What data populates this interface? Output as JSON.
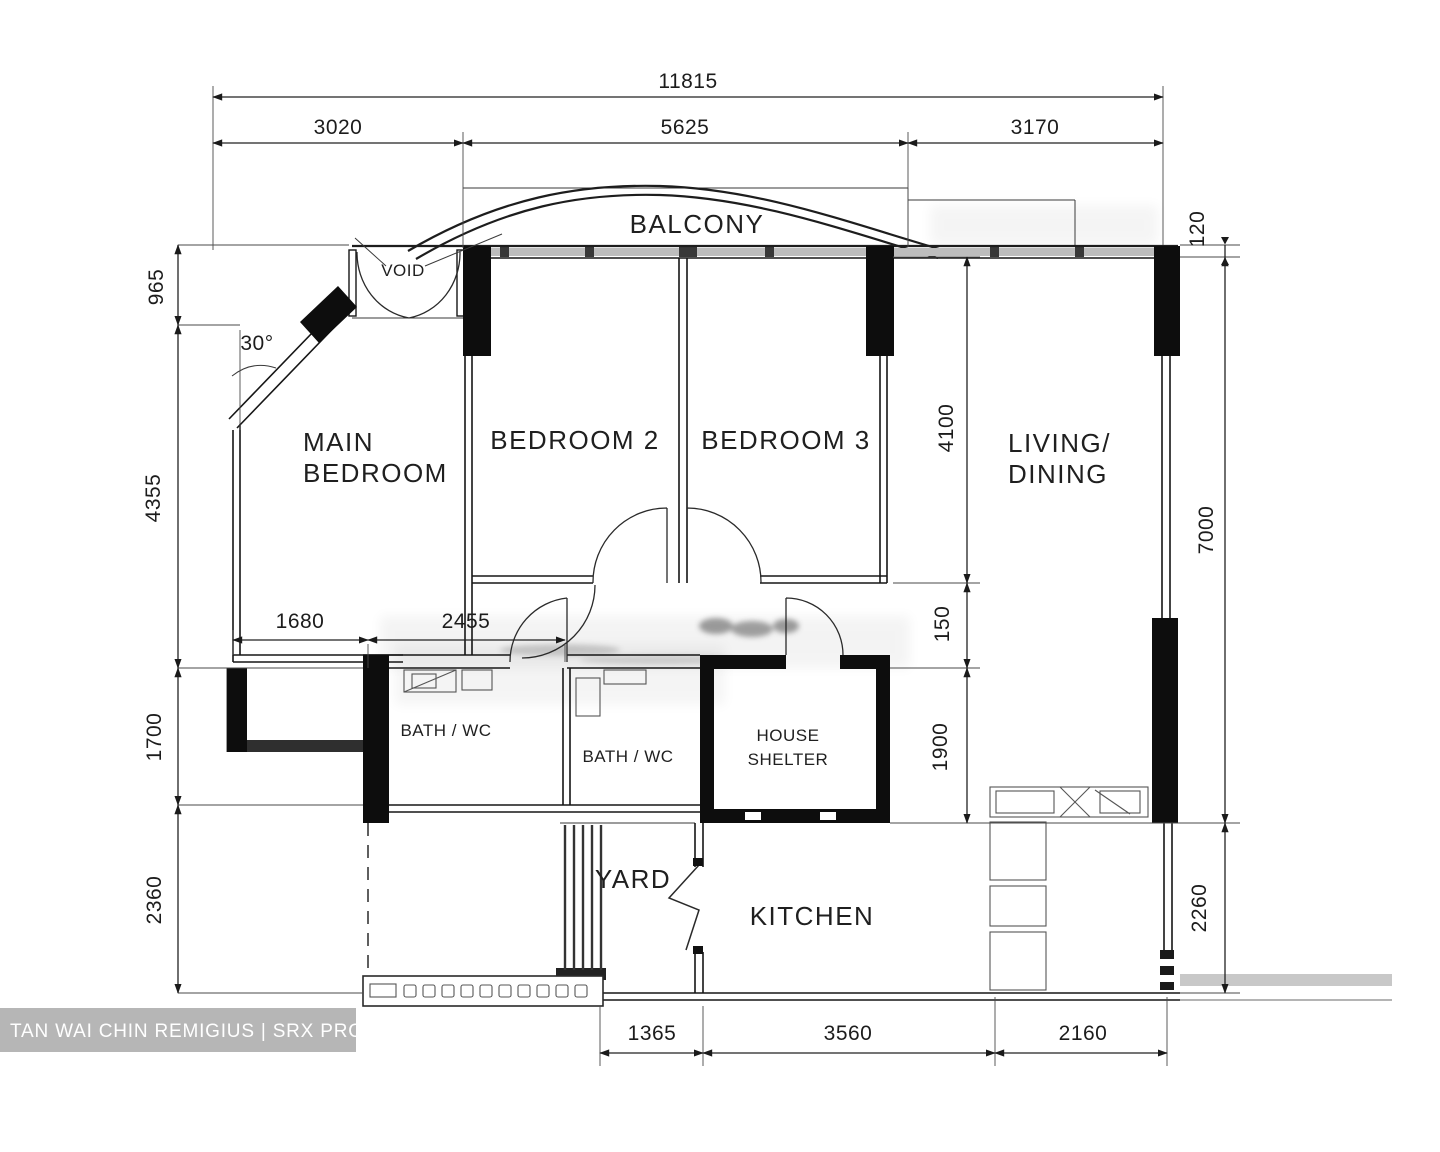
{
  "watermark": {
    "text": "TAN WAI CHIN REMIGIUS | SRX PROPERTY"
  },
  "labels": {
    "balcony": "BALCONY",
    "void": "VOID",
    "main_bedroom_1": "MAIN",
    "main_bedroom_2": "BEDROOM",
    "bedroom2": "BEDROOM 2",
    "bedroom3": "BEDROOM 3",
    "living_1": "LIVING/",
    "living_2": "DINING",
    "bath1": "BATH / WC",
    "bath2": "BATH / WC",
    "shelter_1": "HOUSE",
    "shelter_2": "SHELTER",
    "yard": "YARD",
    "kitchen": "KITCHEN"
  },
  "dims": {
    "total_width": "11815",
    "top_left": "3020",
    "top_mid": "5625",
    "top_right": "3170",
    "offset_120": "120",
    "left_top": "965",
    "angle": "30°",
    "left_mid": "4355",
    "inner_1680": "1680",
    "inner_2455": "2455",
    "left_low": "1700",
    "left_bottom": "2360",
    "right_4100": "4100",
    "right_150": "150",
    "right_1900": "1900",
    "right_7000": "7000",
    "right_2260": "2260",
    "bottom_1365": "1365",
    "bottom_3560": "3560",
    "bottom_2160": "2160"
  }
}
